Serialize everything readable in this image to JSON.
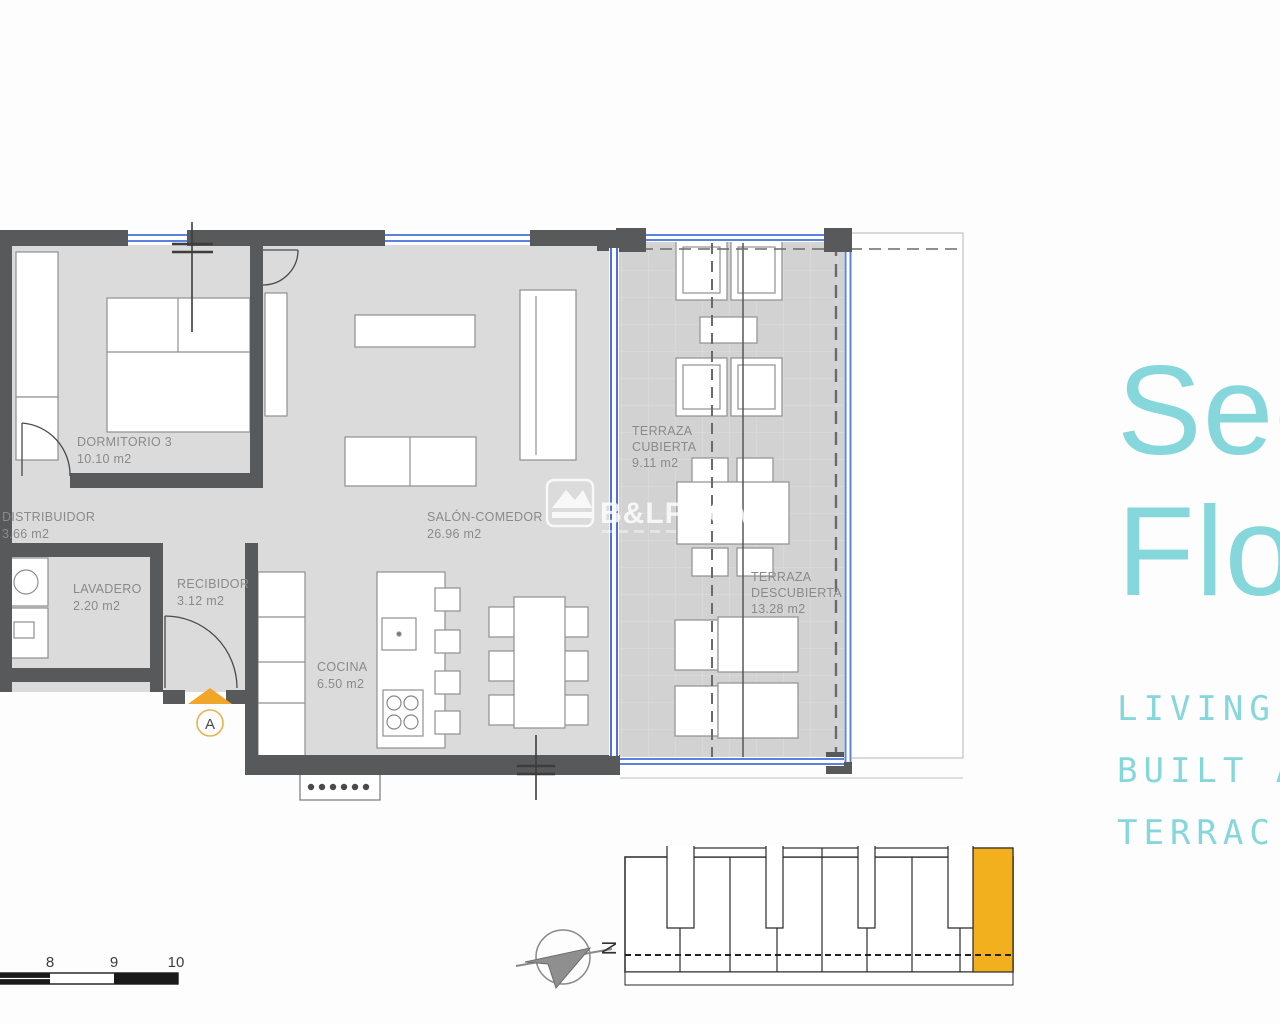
{
  "plan": {
    "rooms": [
      {
        "label": "DORMITORIO 3",
        "area": "10.10 m2"
      },
      {
        "label": "DISTRIBUIDOR",
        "area": "3.66 m2"
      },
      {
        "label": "LAVADERO",
        "area": "2.20 m2"
      },
      {
        "label": "RECIBIDOR",
        "area": "3.12 m2"
      },
      {
        "label": "COCINA",
        "area": "6.50 m2"
      },
      {
        "label": "SALÓN-COMEDOR",
        "area": "26.96 m2"
      },
      {
        "label": "TERRAZA",
        "label2": "CUBIERTA",
        "area": "9.11 m2"
      },
      {
        "label": "TERRAZA",
        "label2": "DESCUBIERTA",
        "area": "13.28 m2"
      }
    ],
    "entrance_marker": "A",
    "north_marker": "N",
    "scale_bar": {
      "ticks": [
        "8",
        "9",
        "10"
      ]
    }
  },
  "watermark": {
    "brand": "B&LPROMO"
  },
  "panel": {
    "title_lines": [
      "Sec",
      "Flo"
    ],
    "caption_lines": [
      "LIVING",
      "BUILT A",
      "TERRAC"
    ]
  },
  "colors": {
    "accent_teal": "#85d7dc",
    "wall": "#58595b",
    "floor": "#dbdbdb",
    "terrace_floor": "#d2d2d2",
    "glazing_blue": "#4d6fe0",
    "window_blue": "#5b82dd",
    "unit_highlight": "#f2b01e",
    "entrance_amber": "#f0a62a",
    "label_gray": "#8a8a8a"
  }
}
